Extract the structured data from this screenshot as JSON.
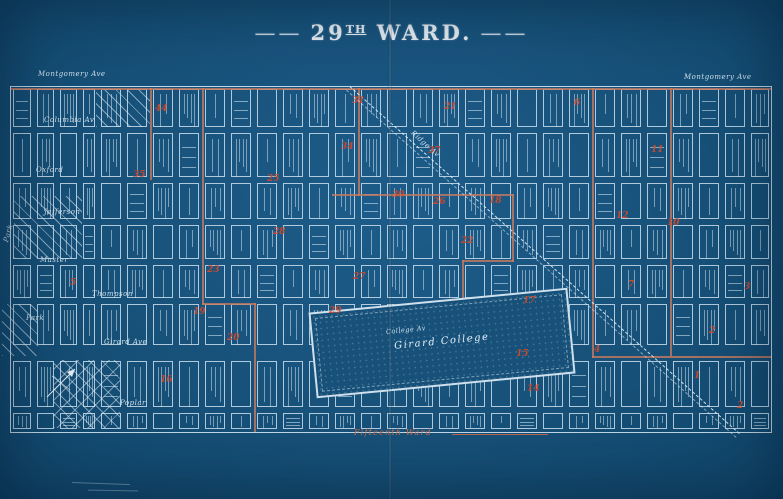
{
  "title": {
    "left_dash": "——",
    "number": "29",
    "ordinal": "TH",
    "word": "WARD.",
    "right_dash": "——"
  },
  "colors": {
    "background": "#175179",
    "street_white": "#dbecf7",
    "boundary_red": "#c87a5f",
    "number_red": "#cd4a2e"
  },
  "map": {
    "frame": {
      "left": 10,
      "top": 86,
      "right": 772,
      "bottom": 432
    },
    "vertical_streets": [
      10,
      34,
      57,
      80,
      98,
      124,
      150,
      176,
      202,
      228,
      254,
      280,
      306,
      332,
      358,
      384,
      410,
      436,
      462,
      488,
      514,
      540,
      566,
      592,
      618,
      644,
      670,
      696,
      722,
      748,
      772
    ],
    "horizontal_streets": [
      86,
      130,
      180,
      222,
      262,
      301,
      348,
      358,
      410,
      432
    ],
    "street_labels": [
      {
        "t": "Montgomery Ave",
        "x": 38,
        "y": 70,
        "r": 0,
        "s": 7
      },
      {
        "t": "Montgomery Ave",
        "x": 684,
        "y": 73,
        "r": 0,
        "s": 7
      },
      {
        "t": "Columbia Av",
        "x": 44,
        "y": 116,
        "r": 0,
        "s": 7
      },
      {
        "t": "Oxford",
        "x": 36,
        "y": 166,
        "r": 0,
        "s": 7
      },
      {
        "t": "Jefferson",
        "x": 44,
        "y": 208,
        "r": 0,
        "s": 7
      },
      {
        "t": "Master",
        "x": 40,
        "y": 256,
        "r": 0,
        "s": 7
      },
      {
        "t": "Thompson",
        "x": 92,
        "y": 290,
        "r": 0,
        "s": 7
      },
      {
        "t": "Girard Ave",
        "x": 104,
        "y": 338,
        "r": 0,
        "s": 7
      },
      {
        "t": "Poplar",
        "x": 120,
        "y": 399,
        "r": 0,
        "s": 7
      },
      {
        "t": "Park",
        "x": 6,
        "y": 238,
        "r": -75,
        "s": 7
      },
      {
        "t": "Park",
        "x": 26,
        "y": 314,
        "r": 0,
        "s": 7
      },
      {
        "t": "Ridge Av",
        "x": 412,
        "y": 128,
        "r": 42,
        "s": 7
      },
      {
        "t": "College Av",
        "x": 386,
        "y": 328,
        "r": -6,
        "s": 6.5
      }
    ],
    "red_numbers": [
      {
        "n": "5",
        "x": 70,
        "y": 278
      },
      {
        "n": "44",
        "x": 155,
        "y": 104
      },
      {
        "n": "35",
        "x": 133,
        "y": 170
      },
      {
        "n": "23",
        "x": 207,
        "y": 265
      },
      {
        "n": "25",
        "x": 267,
        "y": 174
      },
      {
        "n": "28",
        "x": 273,
        "y": 227
      },
      {
        "n": "19",
        "x": 193,
        "y": 307
      },
      {
        "n": "20",
        "x": 227,
        "y": 333
      },
      {
        "n": "16",
        "x": 160,
        "y": 375
      },
      {
        "n": "31",
        "x": 352,
        "y": 96
      },
      {
        "n": "21",
        "x": 444,
        "y": 102
      },
      {
        "n": "34",
        "x": 341,
        "y": 142
      },
      {
        "n": "37",
        "x": 428,
        "y": 146
      },
      {
        "n": "30",
        "x": 392,
        "y": 190
      },
      {
        "n": "26",
        "x": 433,
        "y": 197
      },
      {
        "n": "18",
        "x": 489,
        "y": 196
      },
      {
        "n": "22",
        "x": 461,
        "y": 236
      },
      {
        "n": "27",
        "x": 353,
        "y": 272
      },
      {
        "n": "29",
        "x": 329,
        "y": 306
      },
      {
        "n": "17",
        "x": 523,
        "y": 296
      },
      {
        "n": "15",
        "x": 516,
        "y": 349
      },
      {
        "n": "14",
        "x": 527,
        "y": 384
      },
      {
        "n": "6",
        "x": 574,
        "y": 98
      },
      {
        "n": "11",
        "x": 651,
        "y": 145
      },
      {
        "n": "12",
        "x": 616,
        "y": 211
      },
      {
        "n": "10",
        "x": 667,
        "y": 218
      },
      {
        "n": "7",
        "x": 628,
        "y": 280
      },
      {
        "n": "3",
        "x": 744,
        "y": 282
      },
      {
        "n": "2",
        "x": 709,
        "y": 326
      },
      {
        "n": "4",
        "x": 594,
        "y": 345
      },
      {
        "n": "1",
        "x": 694,
        "y": 371
      },
      {
        "n": "2",
        "x": 737,
        "y": 401
      }
    ],
    "red_lines": [
      {
        "x": 10,
        "y": 88,
        "w": 762,
        "h": 2
      },
      {
        "x": 150,
        "y": 88,
        "w": 2,
        "h": 92
      },
      {
        "x": 202,
        "y": 88,
        "w": 2,
        "h": 217
      },
      {
        "x": 202,
        "y": 303,
        "w": 54,
        "h": 2
      },
      {
        "x": 254,
        "y": 303,
        "w": 2,
        "h": 129
      },
      {
        "x": 358,
        "y": 88,
        "w": 2,
        "h": 108
      },
      {
        "x": 332,
        "y": 194,
        "w": 182,
        "h": 2
      },
      {
        "x": 512,
        "y": 194,
        "w": 2,
        "h": 68
      },
      {
        "x": 462,
        "y": 260,
        "w": 52,
        "h": 2
      },
      {
        "x": 462,
        "y": 260,
        "w": 2,
        "h": 88
      },
      {
        "x": 592,
        "y": 88,
        "w": 2,
        "h": 270
      },
      {
        "x": 592,
        "y": 356,
        "w": 180,
        "h": 2
      },
      {
        "x": 670,
        "y": 88,
        "w": 2,
        "h": 268
      }
    ],
    "hatches": [
      {
        "x": 96,
        "y": 90,
        "w": 54,
        "h": 37,
        "cross": false
      },
      {
        "x": 14,
        "y": 196,
        "w": 68,
        "h": 62,
        "cross": false
      },
      {
        "x": 2,
        "y": 304,
        "w": 36,
        "h": 52,
        "cross": false
      },
      {
        "x": 54,
        "y": 360,
        "w": 66,
        "h": 68,
        "cross": true
      }
    ],
    "ridge_avenue": {
      "label": "Ridge Av",
      "x": 350,
      "y": 86,
      "length": 522,
      "angle_deg": 41.7
    },
    "college": {
      "label": "Girard College",
      "x": 312,
      "y": 300,
      "w": 260,
      "h": 86,
      "rot_deg": -5.5
    },
    "boundary_label": {
      "text": "Fifteenth Ward"
    }
  }
}
